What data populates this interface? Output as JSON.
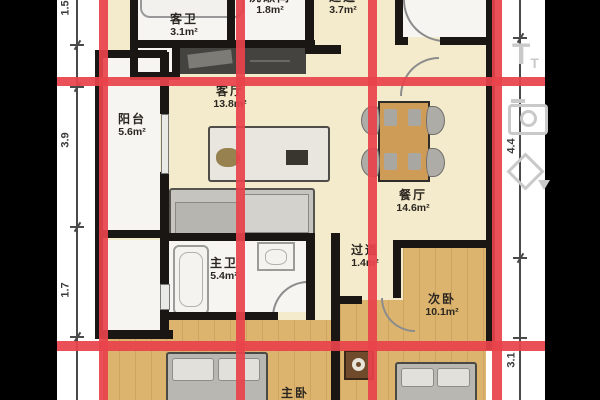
{
  "rooms": [
    {
      "id": "guest-bathroom",
      "name": "客卫",
      "area": "3.1m²"
    },
    {
      "id": "washroom",
      "name": "洗漱间",
      "area": "1.8m²"
    },
    {
      "id": "hallway-top",
      "name": "过道",
      "area": "3.7m²"
    },
    {
      "id": "living-room",
      "name": "客厅",
      "area": "13.8m²"
    },
    {
      "id": "balcony",
      "name": "阳台",
      "area": "5.6m²"
    },
    {
      "id": "dining-room",
      "name": "餐厅",
      "area": "14.6m²"
    },
    {
      "id": "master-bathroom",
      "name": "主卫",
      "area": "5.4m²"
    },
    {
      "id": "hallway-small",
      "name": "过道",
      "area": "1.4m²"
    },
    {
      "id": "secondary-bedroom",
      "name": "次卧",
      "area": "10.1m²"
    },
    {
      "id": "master-bedroom",
      "name": "主卧",
      "area": ""
    }
  ],
  "dimensions": {
    "left": [
      "1.5",
      "3.9",
      "1.7"
    ],
    "right": [
      "4.4",
      "3.1"
    ]
  },
  "toolbar": {
    "text_tool_main": "T",
    "text_tool_sub": "T"
  },
  "colors": {
    "red_grid": "#e8434b",
    "wall": "#191613",
    "floor_cream": "#f4ebcd",
    "floor_wood": "#dcb46e",
    "counter": "#454340",
    "table_wood": "#cf9c58"
  }
}
